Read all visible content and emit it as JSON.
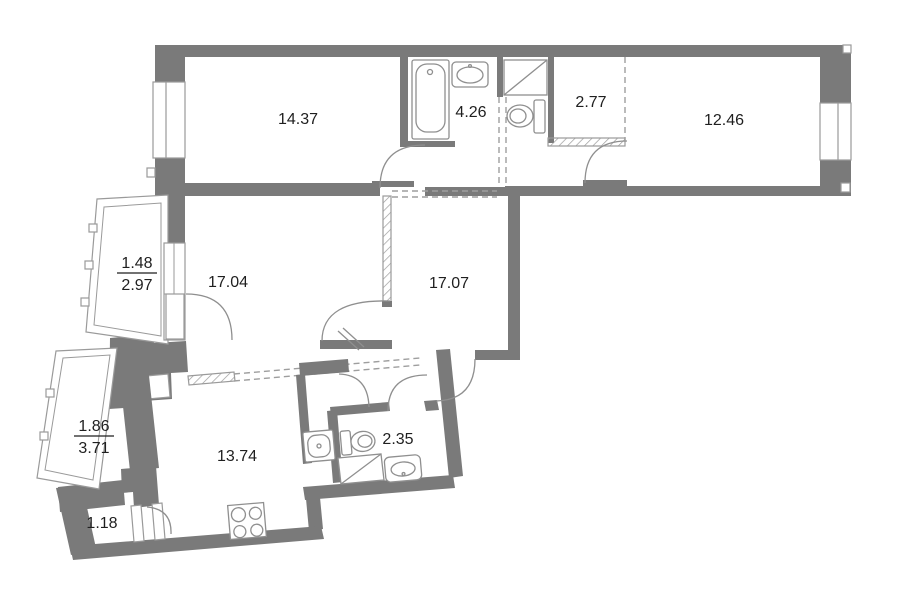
{
  "title": "apartment-floor-plan",
  "colors": {
    "wall": "#7a7a7a",
    "light": "#9a9a9a",
    "fixture": "#8f8f8f",
    "dash": "#9e9e9e",
    "text": "#1f1f1f",
    "background": "#ffffff"
  },
  "rooms": {
    "room_top_left": {
      "area": "14.37"
    },
    "bathroom_top": {
      "area": "4.26"
    },
    "wc_top": {
      "area": "2.77"
    },
    "room_top_right": {
      "area": "12.46"
    },
    "room_mid_left": {
      "area": "17.04"
    },
    "hall_mid": {
      "area": "17.07"
    },
    "kitchen": {
      "area": "13.74"
    },
    "bathroom_low": {
      "area": "2.35"
    },
    "closet": {
      "area": "1.18"
    },
    "balcony_upper": {
      "reduced": "1.48",
      "full": "2.97"
    },
    "balcony_lower": {
      "reduced": "1.86",
      "full": "3.71"
    }
  },
  "fixtures": {
    "bathroom_top": [
      "bathtub",
      "sink",
      "shower-tray",
      "toilet"
    ],
    "bathroom_low": [
      "washing-machine",
      "toilet",
      "shower-tray",
      "sink"
    ],
    "kitchen": [
      "stove"
    ]
  }
}
